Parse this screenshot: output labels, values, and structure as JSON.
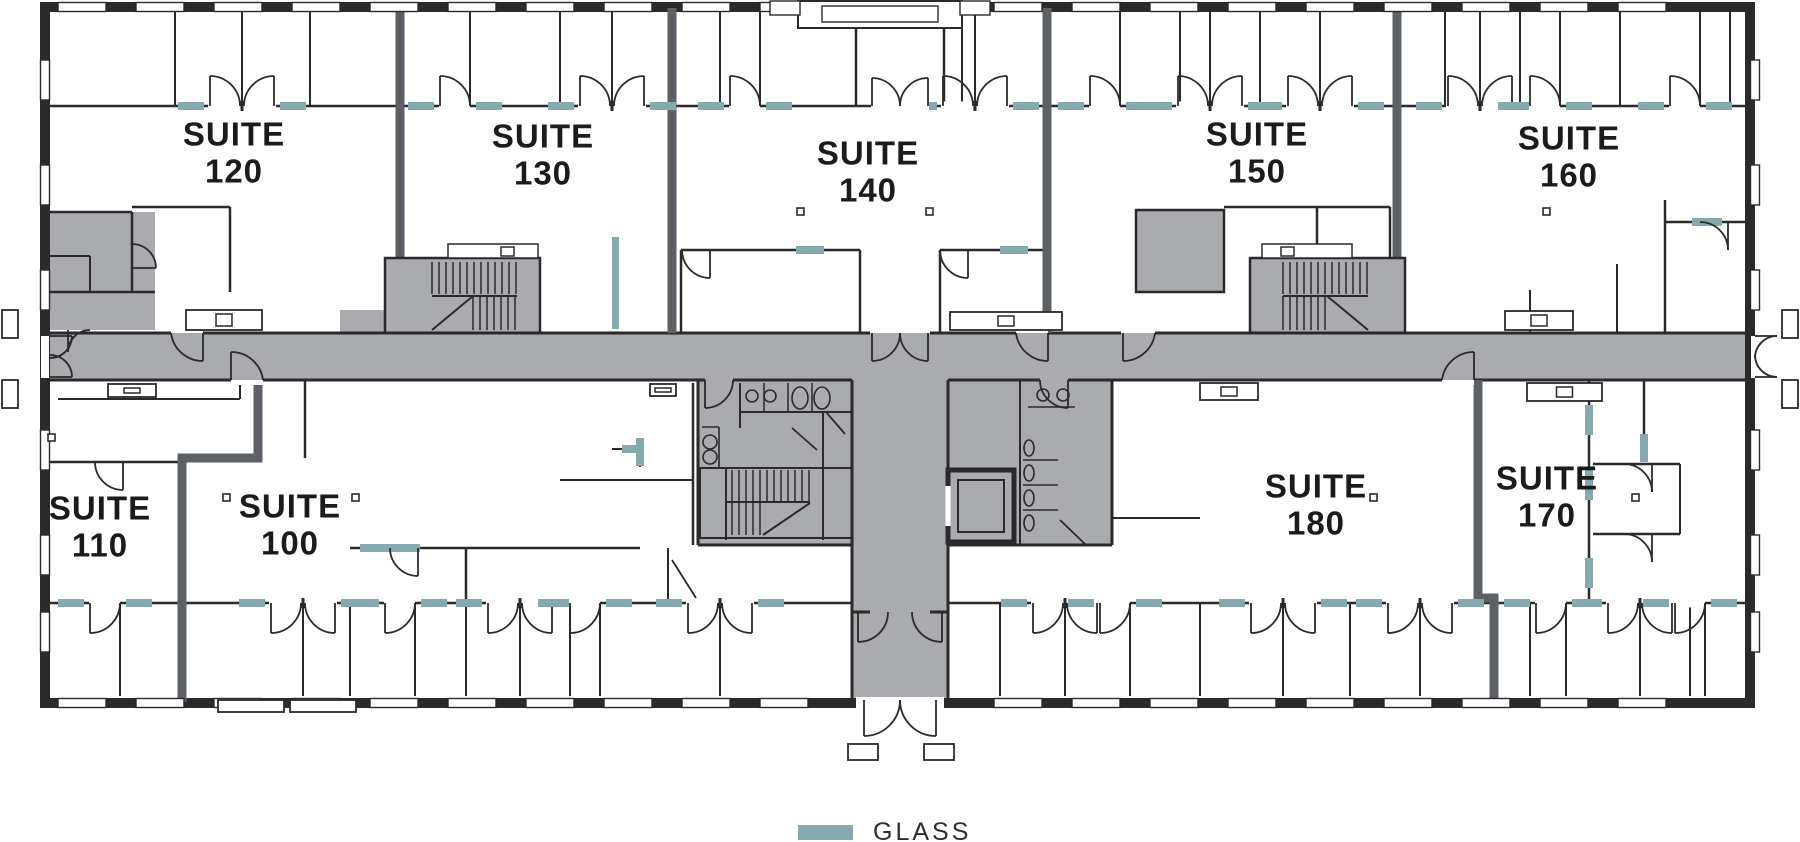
{
  "suites": [
    {
      "id": "120",
      "line1": "SUITE",
      "line2": "120"
    },
    {
      "id": "130",
      "line1": "SUITE",
      "line2": "130"
    },
    {
      "id": "140",
      "line1": "SUITE",
      "line2": "140"
    },
    {
      "id": "150",
      "line1": "SUITE",
      "line2": "150"
    },
    {
      "id": "160",
      "line1": "SUITE",
      "line2": "160"
    },
    {
      "id": "110",
      "line1": "SUITE",
      "line2": "110"
    },
    {
      "id": "100",
      "line1": "SUITE",
      "line2": "100"
    },
    {
      "id": "180",
      "line1": "SUITE",
      "line2": "180"
    },
    {
      "id": "170",
      "line1": "SUITE",
      "line2": "170"
    }
  ],
  "legend": {
    "label": "GLASS"
  },
  "colors": {
    "wall": "#2a2a2a",
    "demising": "#5d6165",
    "floor": "#a9abae",
    "glass": "#86a9b0",
    "paper": "#ffffff",
    "text": "#1b1b1b"
  }
}
